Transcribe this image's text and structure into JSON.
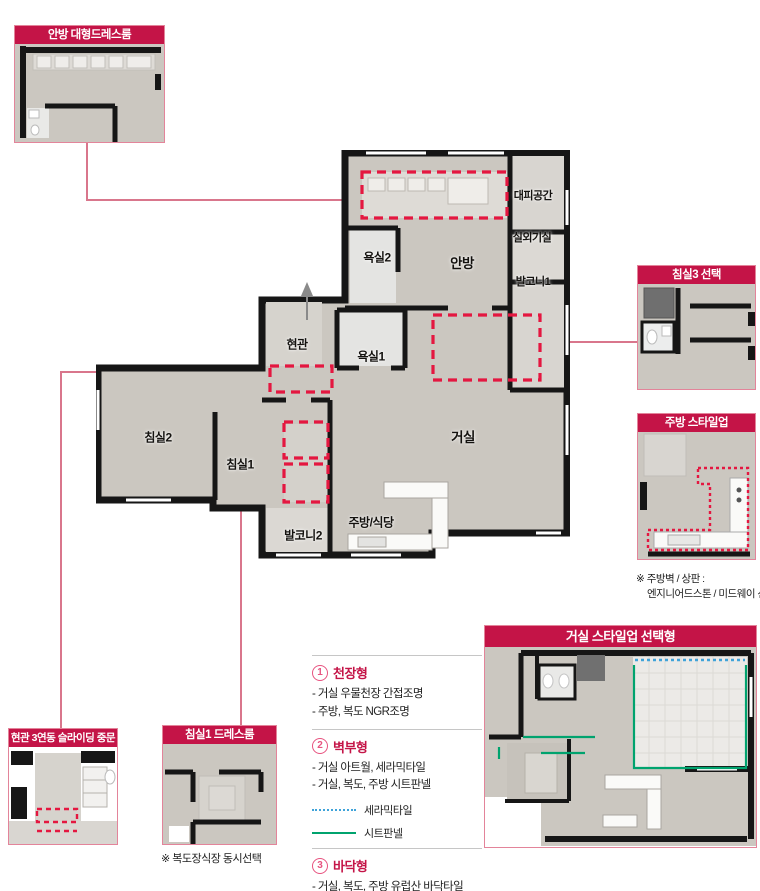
{
  "colors": {
    "accent": "#c41447",
    "inset_border": "#e3849a",
    "leader_pink": "#d9768c",
    "dashed_red": "#e41740",
    "ceramic_blue": "#3fa3d9",
    "sheet_green": "#00a36e",
    "wall_black": "#161616",
    "floor_gray": "#cbc7c0"
  },
  "insets": {
    "master_dress": {
      "title": "안방 대형드레스룸"
    },
    "bed3": {
      "title": "침실3 선택"
    },
    "kitchen": {
      "title": "주방 스타일업",
      "note1": "※ 주방벽 / 상판 :",
      "note2": "엔지니어드스톤 / 미드웨이 선반"
    },
    "living": {
      "title": "거실 스타일업 선택형"
    },
    "entrance": {
      "title": "현관 3연동 슬라이딩 중문"
    },
    "bed1_dress": {
      "title": "침실1 드레스룸",
      "note": "※ 복도장식장 동시선택"
    }
  },
  "floorplan": {
    "labels": {
      "escape": "대피공간",
      "outdoor_unit": "실외기실",
      "bath2": "욕실2",
      "master": "안방",
      "balcony1": "발코니1",
      "entry": "현관",
      "bath1": "욕실1",
      "bed2": "침실2",
      "bed1": "침실1",
      "living": "거실",
      "kitchen": "주방/식당",
      "balcony2": "발코니2"
    }
  },
  "options": {
    "s1": {
      "num": "1",
      "title": "천장형",
      "item1": "- 거실 우물천장 간접조명",
      "item2": "- 주방, 복도 NGR조명"
    },
    "s2": {
      "num": "2",
      "title": "벽부형",
      "item1": "- 거실 아트월, 세라믹타일",
      "item2": "- 거실, 복도, 주방 시트판넬",
      "legend1": "세라믹타일",
      "legend2": "시트판넬"
    },
    "s3": {
      "num": "3",
      "title": "바닥형",
      "item1": "- 거실, 복도, 주방 유럽산 바닥타일"
    }
  }
}
